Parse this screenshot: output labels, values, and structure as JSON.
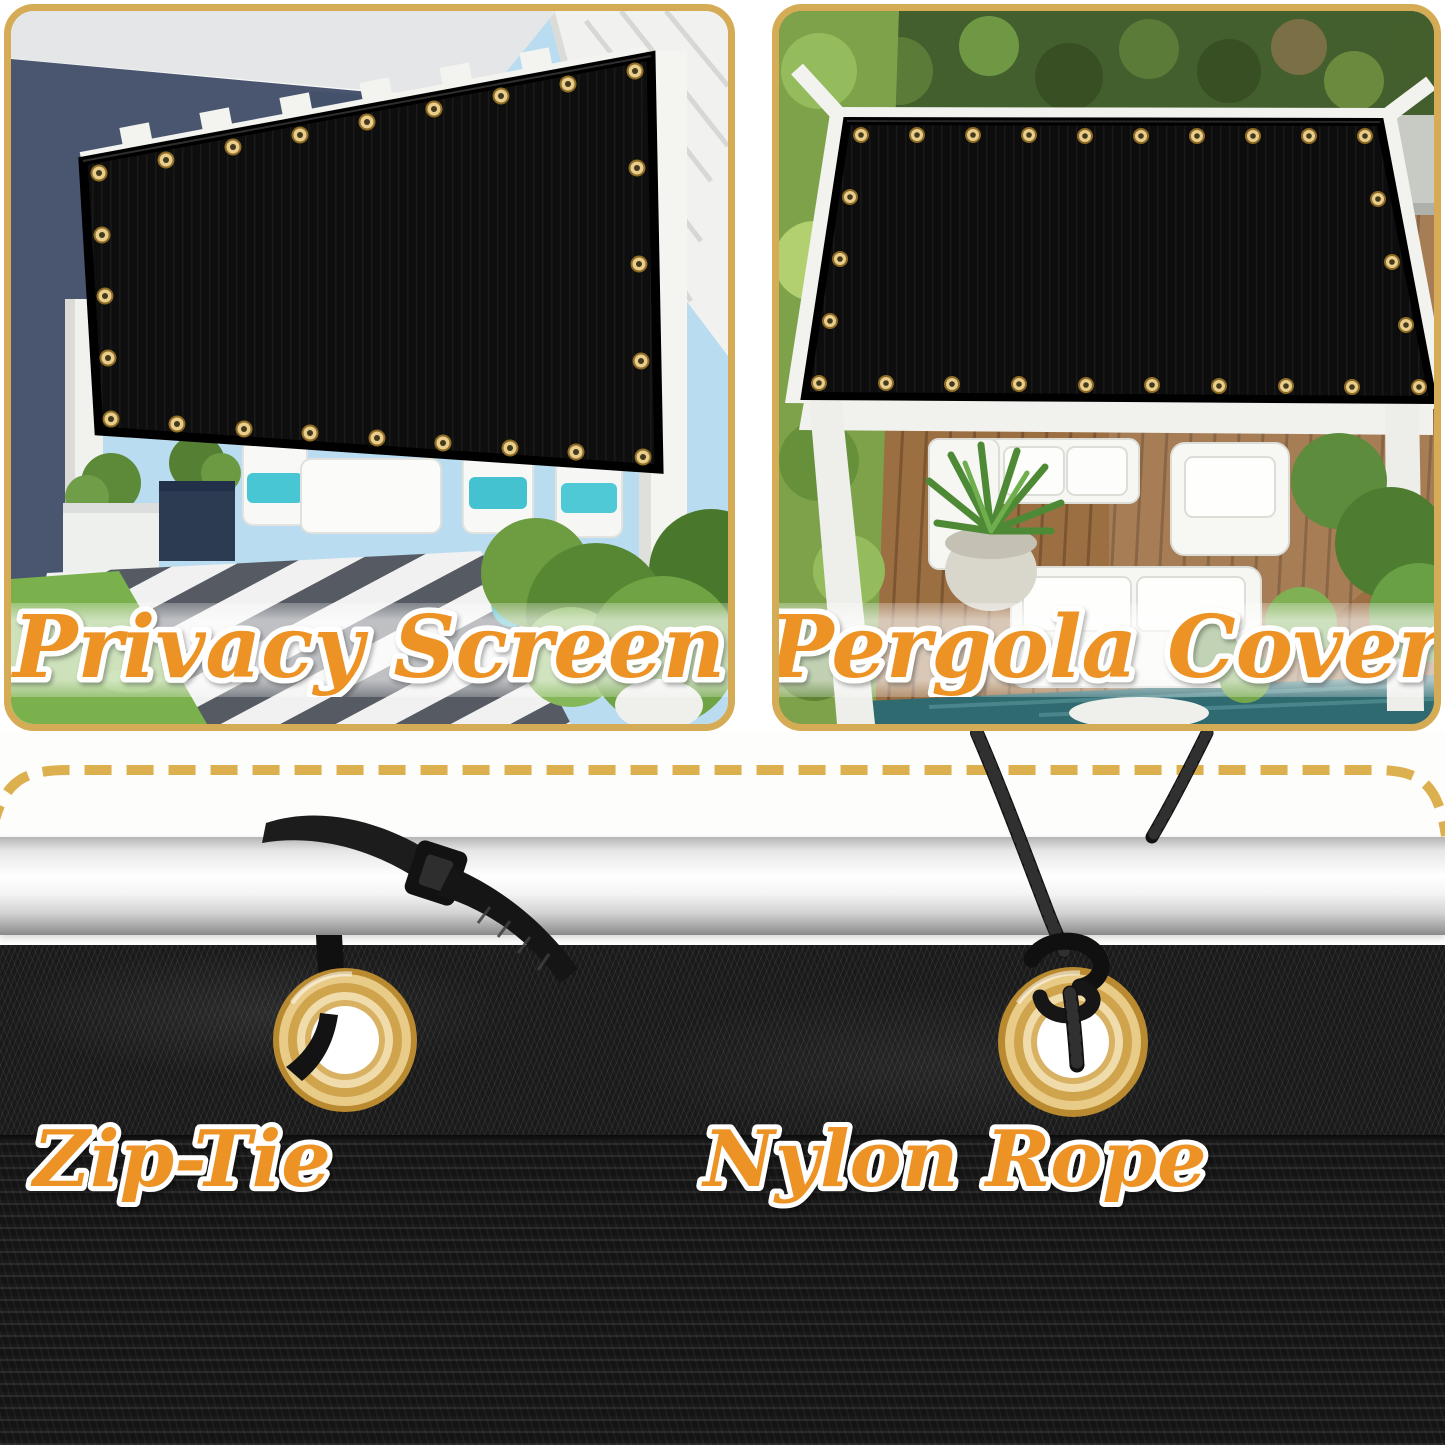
{
  "panels": [
    {
      "id": "privacy-screen",
      "caption": "Privacy Screen"
    },
    {
      "id": "pergola-cover",
      "caption": "Pergola Cover"
    }
  ],
  "installation": {
    "zip_tie_label": "Zip-Tie",
    "nylon_rope_label": "Nylon Rope"
  },
  "icons": {
    "grommet": "gold-brass-ring",
    "zip_tie": "black-cable-tie",
    "nylon_rope": "black-braided-rope",
    "pole": "silver-rail",
    "dashed_border": "gold-dashed-line"
  },
  "colors": {
    "caption_orange": "#ED9327",
    "caption_outline": "#FFFFFF",
    "panel_border_gold": "#D5AC55",
    "dashed_line_gold": "#DCB04F",
    "grommet_brass": "#D9A94F",
    "shade_mesh_black": "#181818",
    "pole_silver": "#E8E8E8",
    "cushion_teal": "#49C6D3"
  }
}
